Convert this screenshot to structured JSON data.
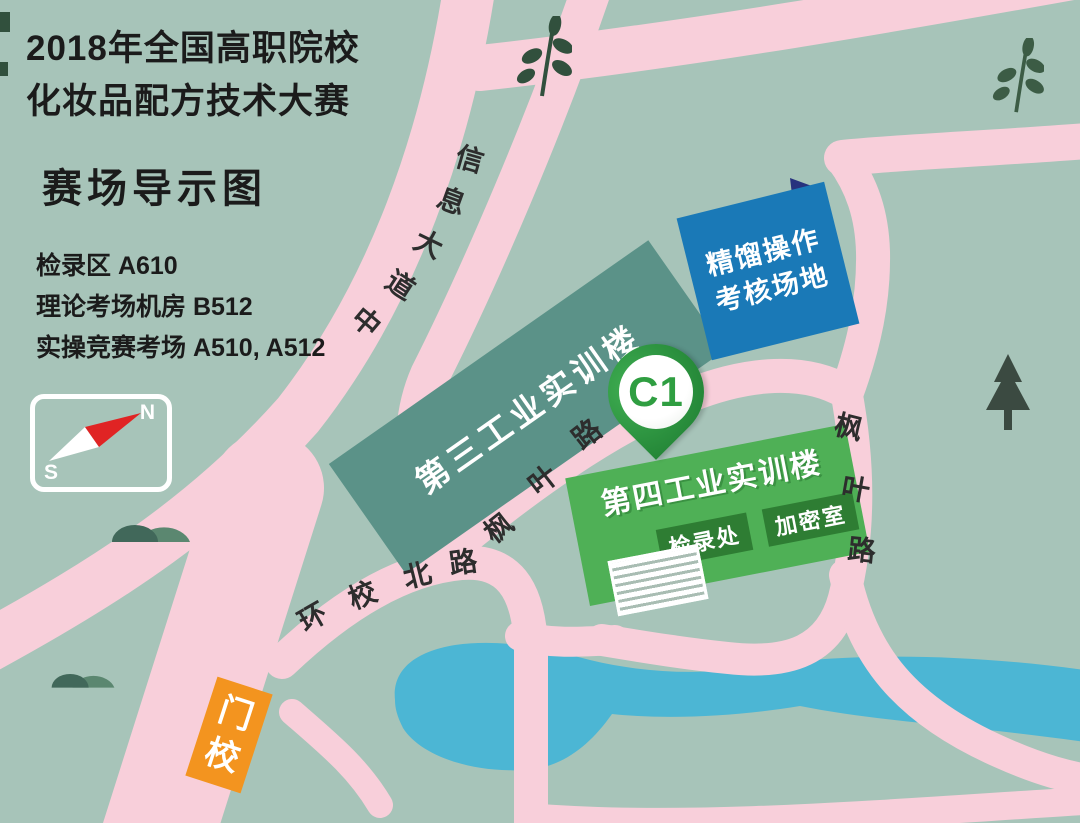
{
  "page": {
    "title_line1": "2018年全国高职院校",
    "title_line2": "化妆品配方技术大赛",
    "subtitle": "赛场导示图"
  },
  "legend": {
    "items": [
      "检录区 A610",
      "理论考场机房 B512",
      "实操竞赛考场 A510, A512"
    ]
  },
  "compass": {
    "north_label": "N",
    "south_label": "S"
  },
  "marker": {
    "label": "C1"
  },
  "gate": {
    "name": "校门",
    "char_top": "门",
    "char_bottom": "校"
  },
  "buildings": {
    "third_industrial_training": {
      "label": "第三工业实训楼"
    },
    "fourth_industrial_training": {
      "label": "第四工业实训楼",
      "checkin_label": "检录处",
      "encryption_label": "加密室",
      "security_label": "安检口"
    },
    "distillation_area": {
      "line1": "精馏操作",
      "line2": "考核场地"
    }
  },
  "roads": {
    "xinxi_avenue": {
      "name": "信息大道中",
      "chars": [
        "信",
        "息",
        "大",
        "道",
        "中"
      ]
    },
    "fengye_road_mid": {
      "name": "枫叶路",
      "chars": [
        "枫",
        "叶",
        "路"
      ]
    },
    "huanxiao_north_road": {
      "name": "环校北路",
      "chars": [
        "环",
        "校",
        "北",
        "路"
      ]
    },
    "fengye_road_right": {
      "name": "枫叶路",
      "chars": [
        "枫",
        "叶",
        "路"
      ]
    }
  },
  "colors": {
    "background": "#a7c4b9",
    "road_pink": "#f8cfda",
    "water_blue": "#4cb6d4",
    "building_teal": "#5b9288",
    "building_green": "#4fb056",
    "building_blue": "#1a79b7",
    "label_box_green": "#2e7d33",
    "gate_orange": "#f3941f",
    "pin_green": "#2f9e41",
    "needle_red": "#e02424"
  }
}
